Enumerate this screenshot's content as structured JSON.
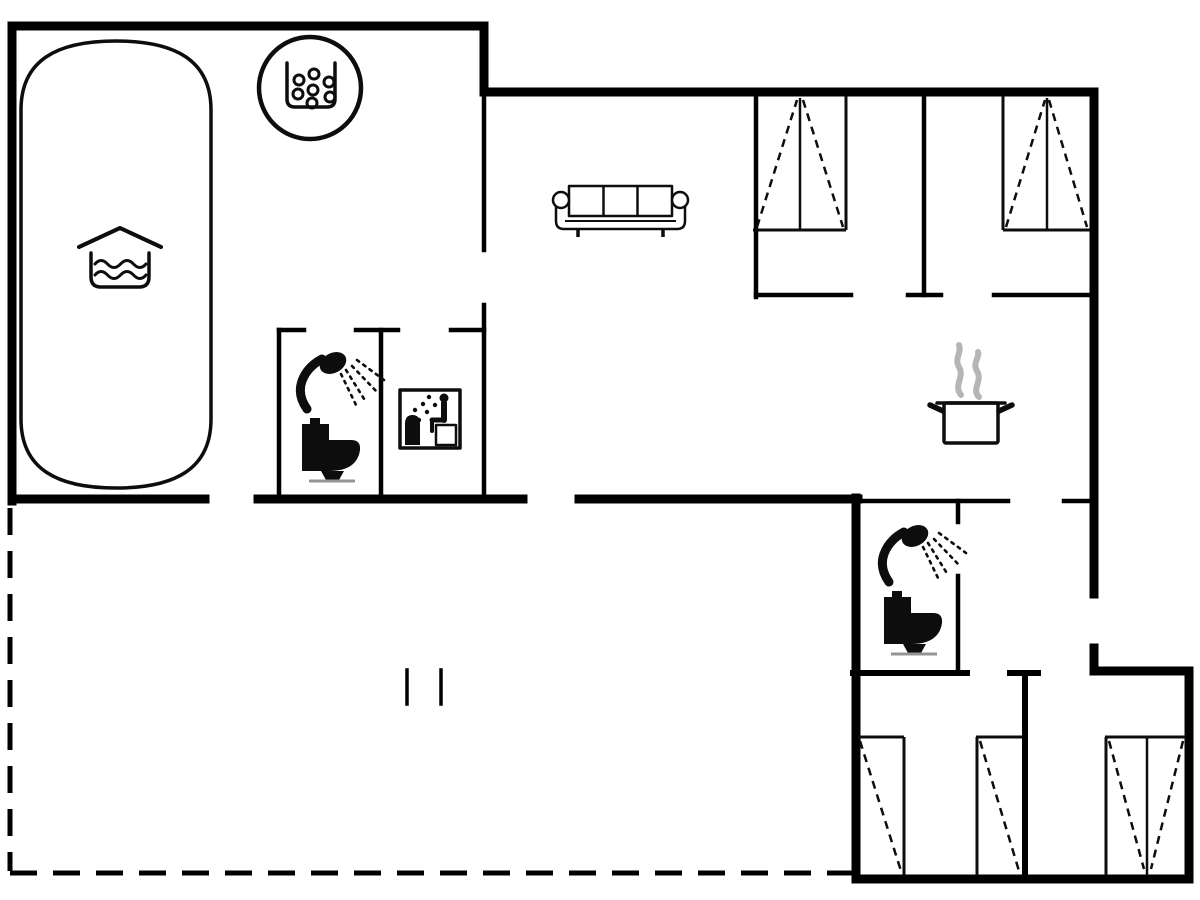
{
  "canvas": {
    "width": 1200,
    "height": 900
  },
  "colors": {
    "background": "#ffffff",
    "wall": "#000000",
    "line": "#0d0d0d",
    "muted": "#949494",
    "steam": "#b5b5b5"
  },
  "plan": {
    "type": "residential-floor-plan",
    "boundary_styles": {
      "walls": "solid-black",
      "terrace": "dashed-outline"
    },
    "icons": [
      {
        "name": "swimming-pool",
        "count": 1
      },
      {
        "name": "pool-water-roof-icon",
        "count": 1
      },
      {
        "name": "whirlpool-icon",
        "count": 1
      },
      {
        "name": "sofa-icon",
        "count": 1
      },
      {
        "name": "wardrobe-icon",
        "count": 5
      },
      {
        "name": "shower-icon",
        "count": 2
      },
      {
        "name": "toilet-icon",
        "count": 2
      },
      {
        "name": "sauna-icon",
        "count": 1
      },
      {
        "name": "cooking-pot-icon",
        "count": 1
      },
      {
        "name": "steam-icon",
        "count": 1
      },
      {
        "name": "door-post-marks",
        "count": 2
      }
    ]
  }
}
